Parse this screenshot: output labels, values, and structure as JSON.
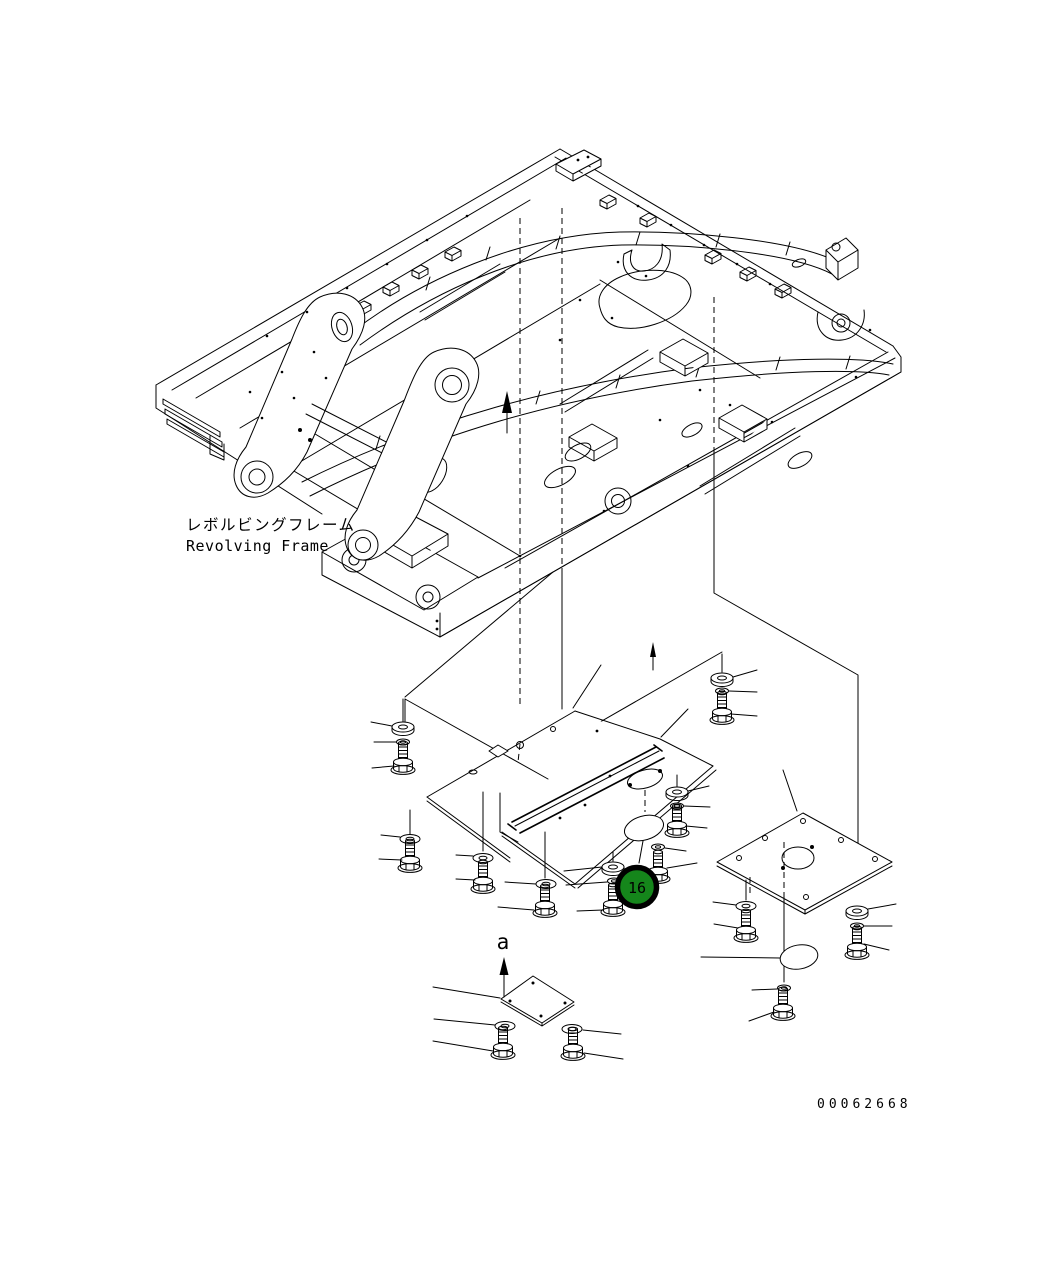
{
  "canvas": {
    "width": 1055,
    "height": 1262,
    "background": "#ffffff",
    "line_color": "#000000"
  },
  "labels": {
    "title_jp": "レボルビングフレーム",
    "title_en": "Revolving Frame",
    "section_arrow": "a",
    "drawing_number": "00062668"
  },
  "callout": {
    "number": "16",
    "fill_color": "#15861b",
    "ring_color": "#000000",
    "text_color": "#ffffff"
  },
  "drawing": {
    "type": "isometric exploded parts diagram",
    "main_part": "revolving frame",
    "exploded_parts": [
      "under cover plate (bent)",
      "under cover plate with channel",
      "square cover plate with round hole",
      "small square cover plate",
      "oval cover (callout 16)",
      "oval cover (rear)"
    ],
    "fastener_sets": 13,
    "fastener_elements": [
      "hex bolt",
      "flat washer",
      "spring washer"
    ]
  }
}
